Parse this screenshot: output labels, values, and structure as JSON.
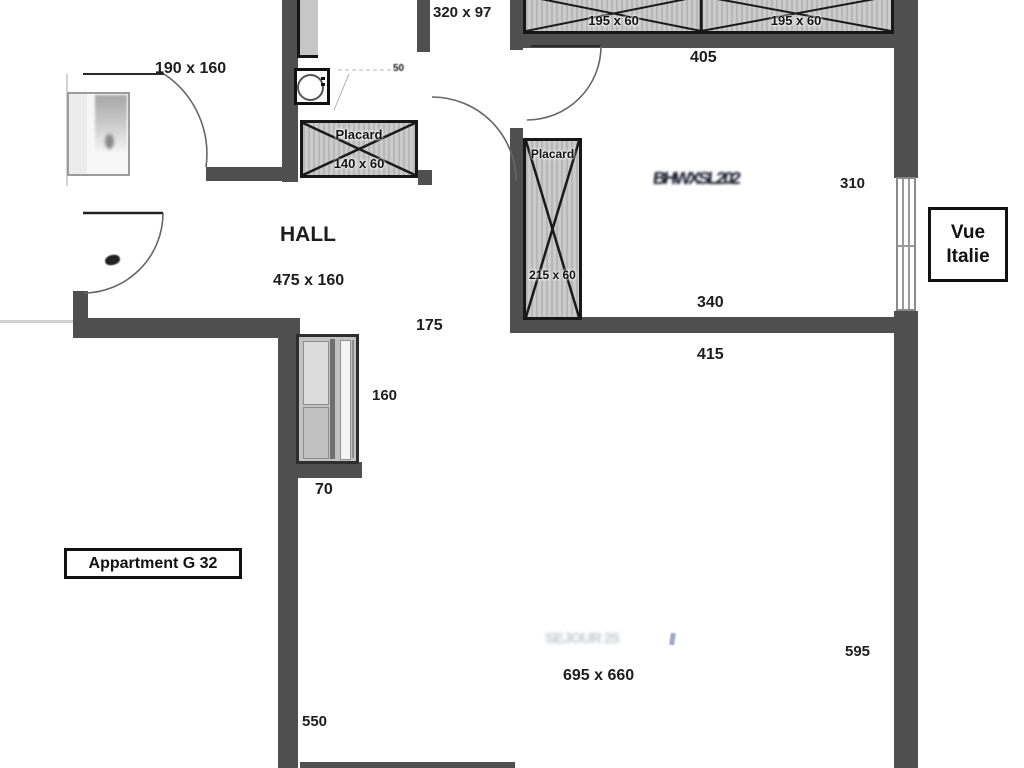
{
  "colors": {
    "wall": "#4f4f4f",
    "arc_line": "#666666",
    "text": "#1d1d1d"
  },
  "plan": {
    "apartment_box_label": "Appartment G 32",
    "vue_box": {
      "line1": "Vue",
      "line2": "Italie"
    },
    "rooms": {
      "hall_name": "HALL",
      "hall_dim": "475 x 160",
      "bedroom_dim": "190 x 160",
      "bathroom_dim": "320 x 97",
      "living_dim": "695 x 660"
    },
    "closets": {
      "top_left_dim": "195 x 60",
      "top_right_dim": "195 x 60",
      "hall_name": "Placard",
      "hall_dim": "140 x 60",
      "entry_name": "Placard",
      "entry_dim": "215 x 60"
    },
    "dims": {
      "d405": "405",
      "d310": "310",
      "d340": "340",
      "d415": "415",
      "d175": "175",
      "d160": "160",
      "d70": "70",
      "d550": "550",
      "d595": "595",
      "d50": "50"
    },
    "smudges": {
      "entry_room": "BHWXSL202",
      "living": "SEJOUR 25"
    }
  }
}
